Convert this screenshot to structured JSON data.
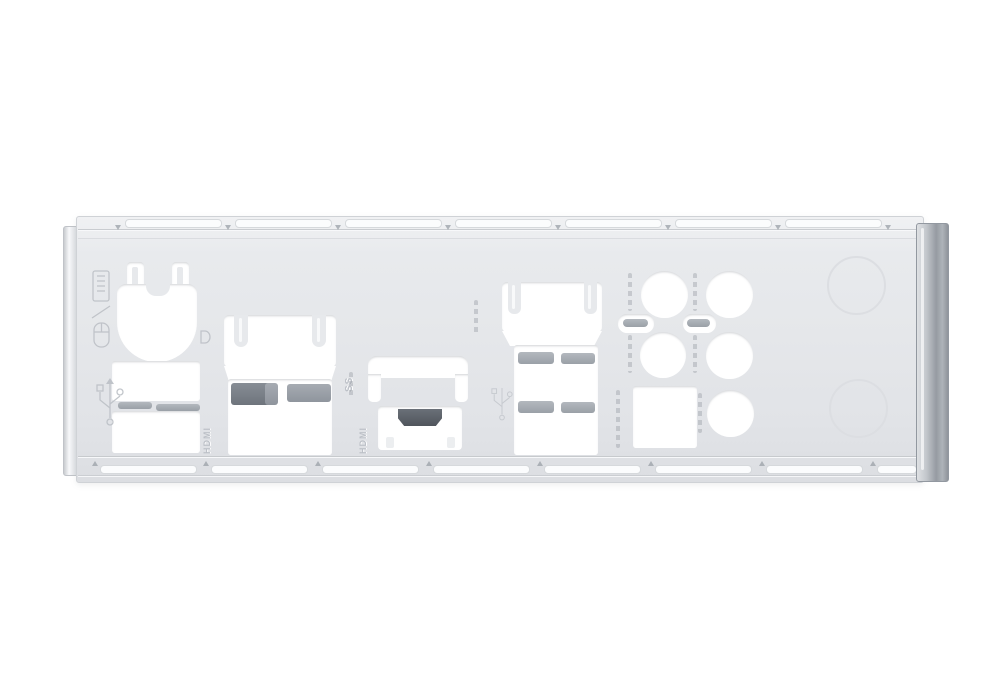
{
  "photo": {
    "subject": "Metal motherboard rear I/O shield backplate, photographed on a plain white background",
    "background_color": "#ffffff",
    "plate_color": "#e4e6e9",
    "cutout_color": "#ffffff",
    "grounding_tab_color": "#8d939b",
    "hdmi_hole_color": "#5d636b",
    "emboss_color": "#c2c6cc",
    "right_fold_color": "#969ba2"
  },
  "labels": {
    "hdmi_port_left": "HDMI",
    "hdmi_port_middle": "HDMI",
    "usb3_superspeed": "SS"
  },
  "icons": [
    "keyboard-mouse-icon",
    "usb-icon",
    "usb-icon-2",
    "usb3-superspeed-icon",
    "ring-emboss-icon",
    "audio-jack-emboss-marks",
    "spdif-emboss-marks",
    "lan-emboss-marks"
  ]
}
